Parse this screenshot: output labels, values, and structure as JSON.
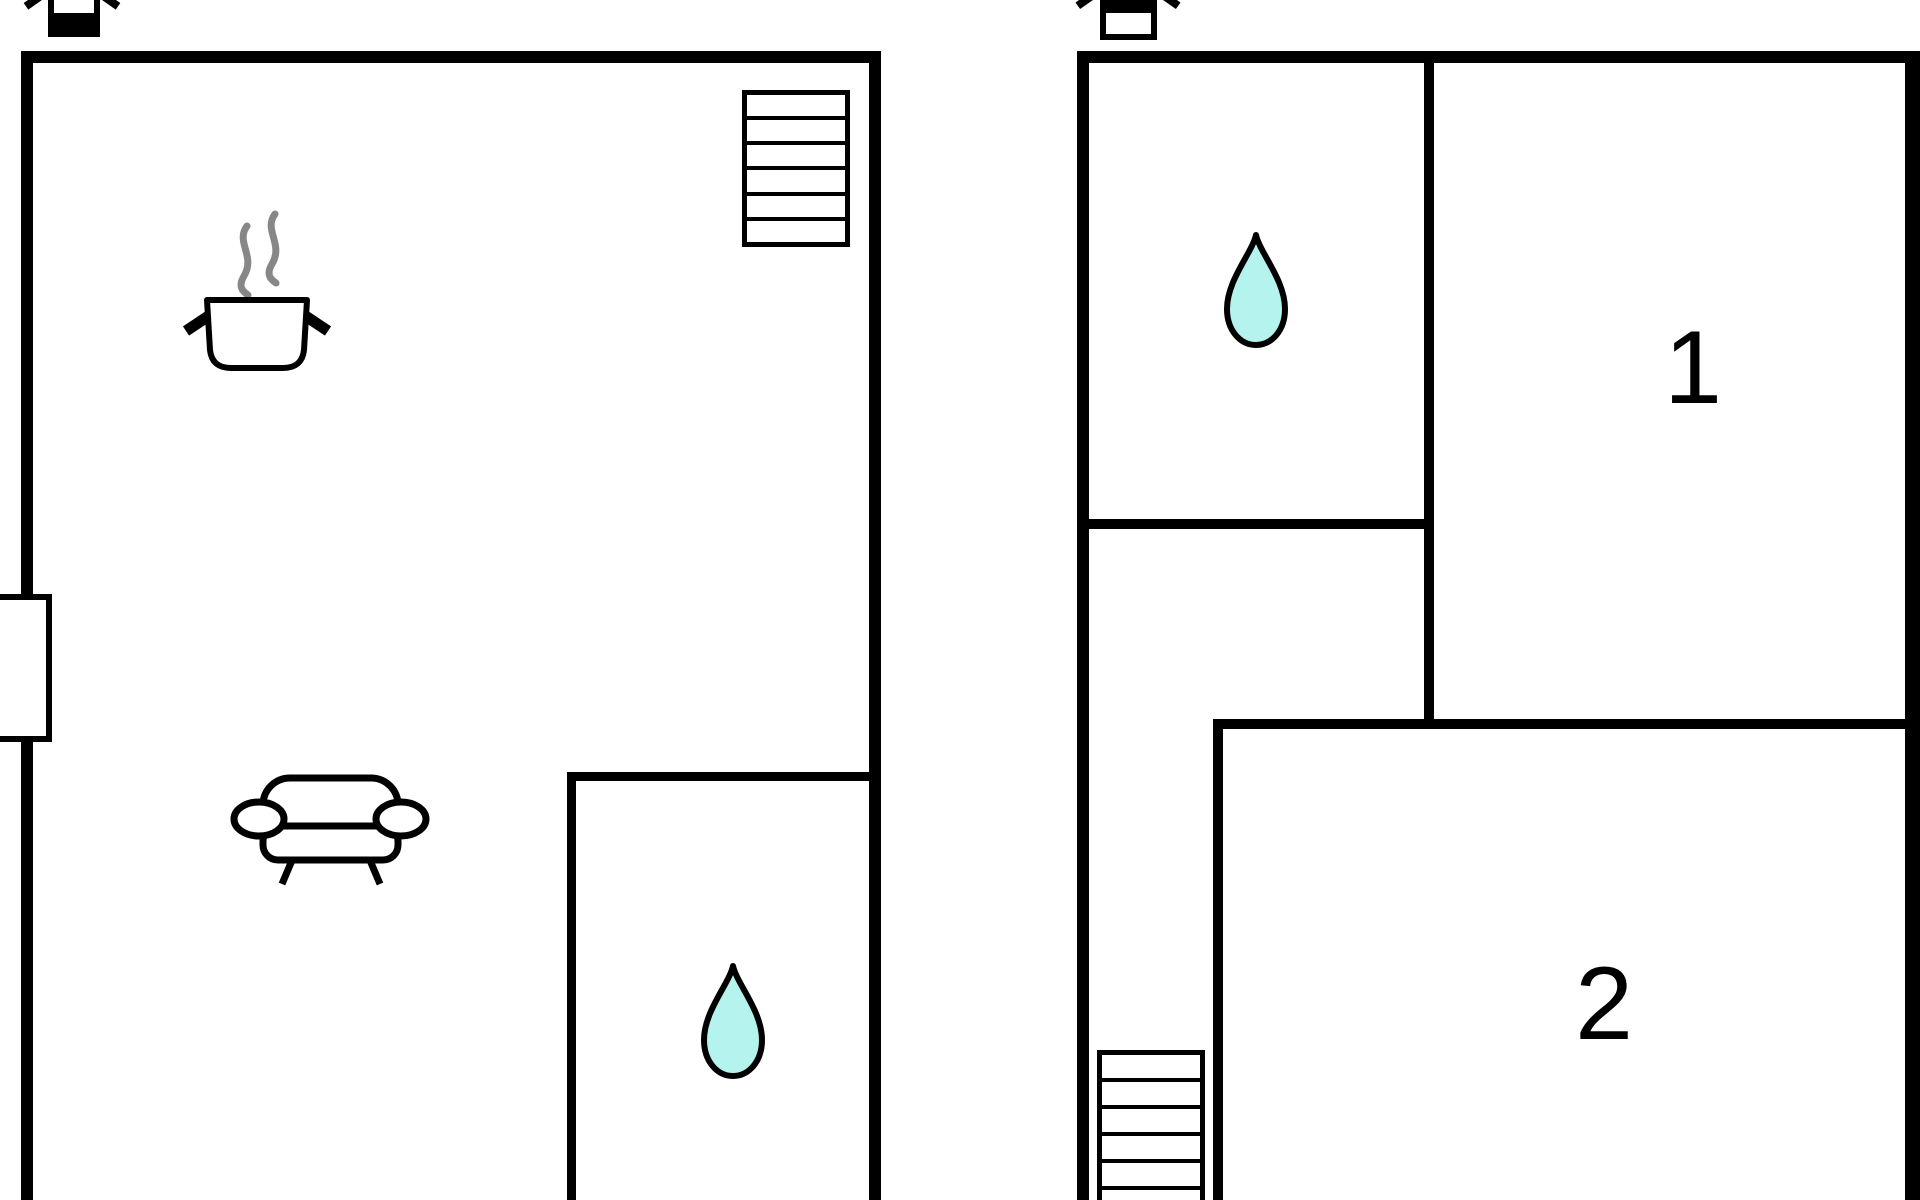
{
  "colors": {
    "wall": "#000000",
    "background": "#ffffff",
    "water-fill": "#b5f3ef",
    "steam": "#878787"
  },
  "floor_a": {
    "story_icon": "building-story-indicator-lower-filled",
    "features": {
      "staircase": "staircase-icon",
      "kitchen": "steaming-pot-icon",
      "living": "sofa-icon",
      "bathroom": "water-drop-icon",
      "entry": "wall-opening"
    }
  },
  "floor_b": {
    "story_icon": "building-story-indicator-upper-filled",
    "features": {
      "bathroom": "water-drop-icon",
      "staircase": "staircase-icon"
    },
    "rooms": {
      "room1": {
        "label": "1"
      },
      "room2": {
        "label": "2"
      }
    }
  }
}
